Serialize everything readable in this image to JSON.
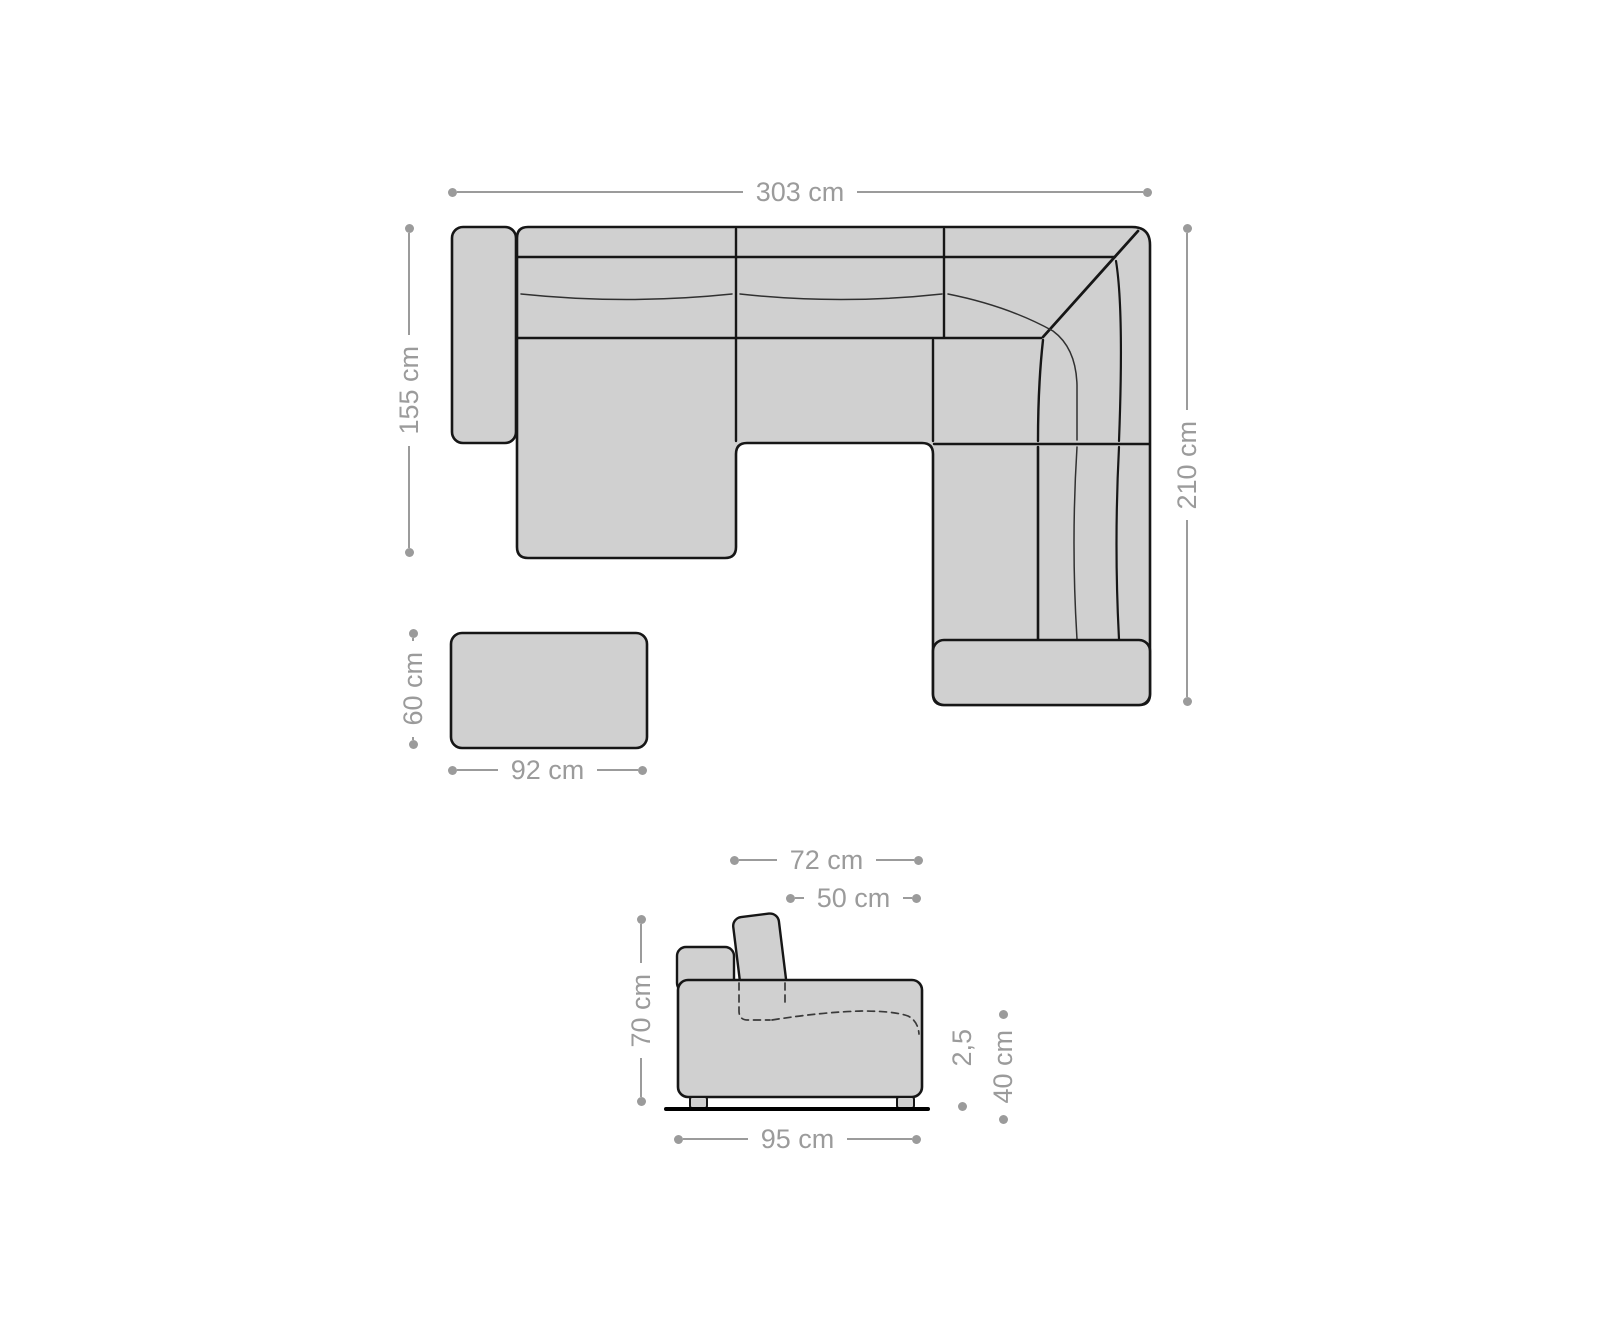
{
  "diagram": {
    "subject": "Corner sofa dimension drawing: top view with stool and side profile view",
    "colors": {
      "background": "#ffffff",
      "furniture_fill": "#d0d0d0",
      "outline": "#161616",
      "dimension_gray": "#9b9b9b"
    },
    "top_view": {
      "total_width": "303 cm",
      "recamiere_depth": "155 cm",
      "corner_depth": "210 cm"
    },
    "stool": {
      "depth": "60 cm",
      "width": "92 cm"
    },
    "side_view": {
      "depth_with_backrest": "72 cm",
      "backrest_cushion_width": "50 cm",
      "total_height": "70 cm",
      "base_depth": "95 cm",
      "foot_height": "2,5",
      "seat_height": "40 cm"
    }
  }
}
